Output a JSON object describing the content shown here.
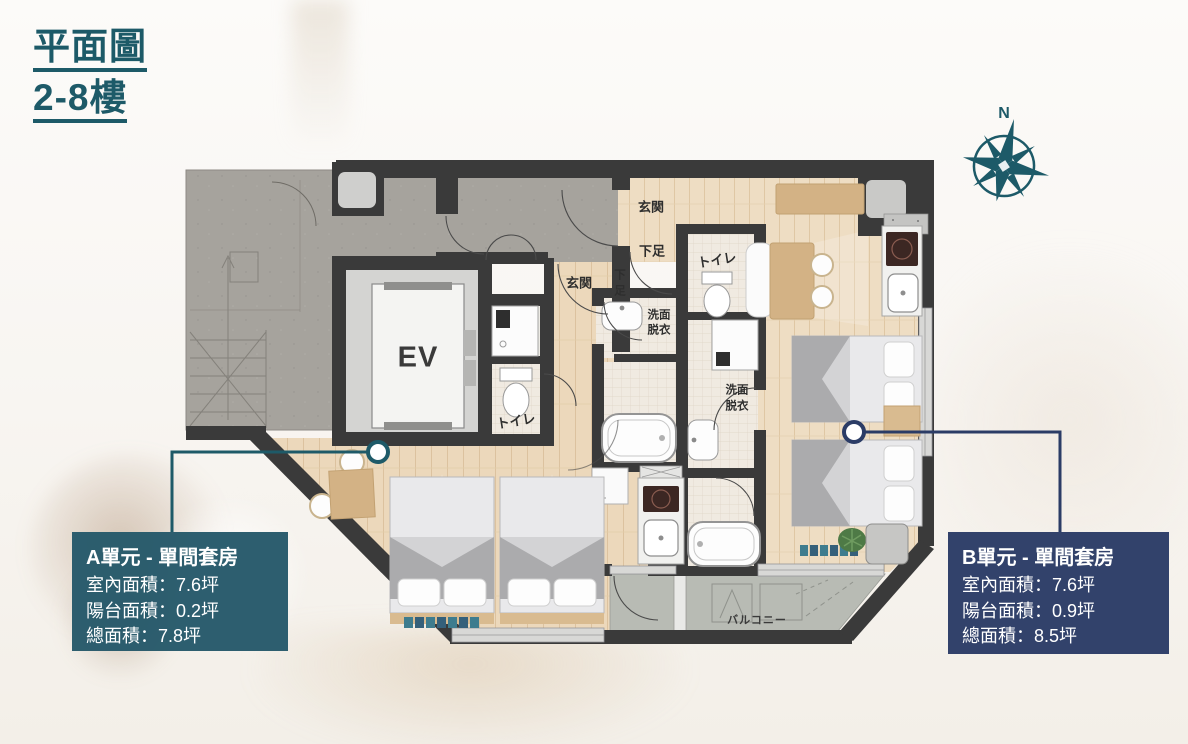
{
  "header": {
    "title_line1": "平面圖",
    "title_line2": "2-8樓"
  },
  "compass": {
    "north_label": "N"
  },
  "floorplan": {
    "ev_label": "EV",
    "labels": {
      "genkan_a": "玄関",
      "genkan_b": "玄関",
      "geta_b": "下足",
      "geta_a_char1": "下",
      "geta_a_char2": "足",
      "toilet_a": "トイレ",
      "toilet_b": "トイレ",
      "washroom_line1": "洗面",
      "washroom_line2": "脱衣",
      "balcony": "バルコニー"
    }
  },
  "unit_a": {
    "title": "A單元 - 單間套房",
    "lines": [
      "室內面積：7.6坪",
      "陽台面積：0.2坪",
      "總面積：7.8坪"
    ],
    "accent_color": "#1e5a68"
  },
  "unit_b": {
    "title": "B單元 - 單間套房",
    "lines": [
      "室內面積：7.6坪",
      "陽台面積：0.9坪",
      "總面積：8.5坪"
    ],
    "accent_color": "#2b3c66"
  },
  "colors": {
    "wall": "#3a3a3a",
    "wood": "#ecd8bb",
    "concrete": "#a6a39d",
    "balcony": "#b8bbb4"
  }
}
